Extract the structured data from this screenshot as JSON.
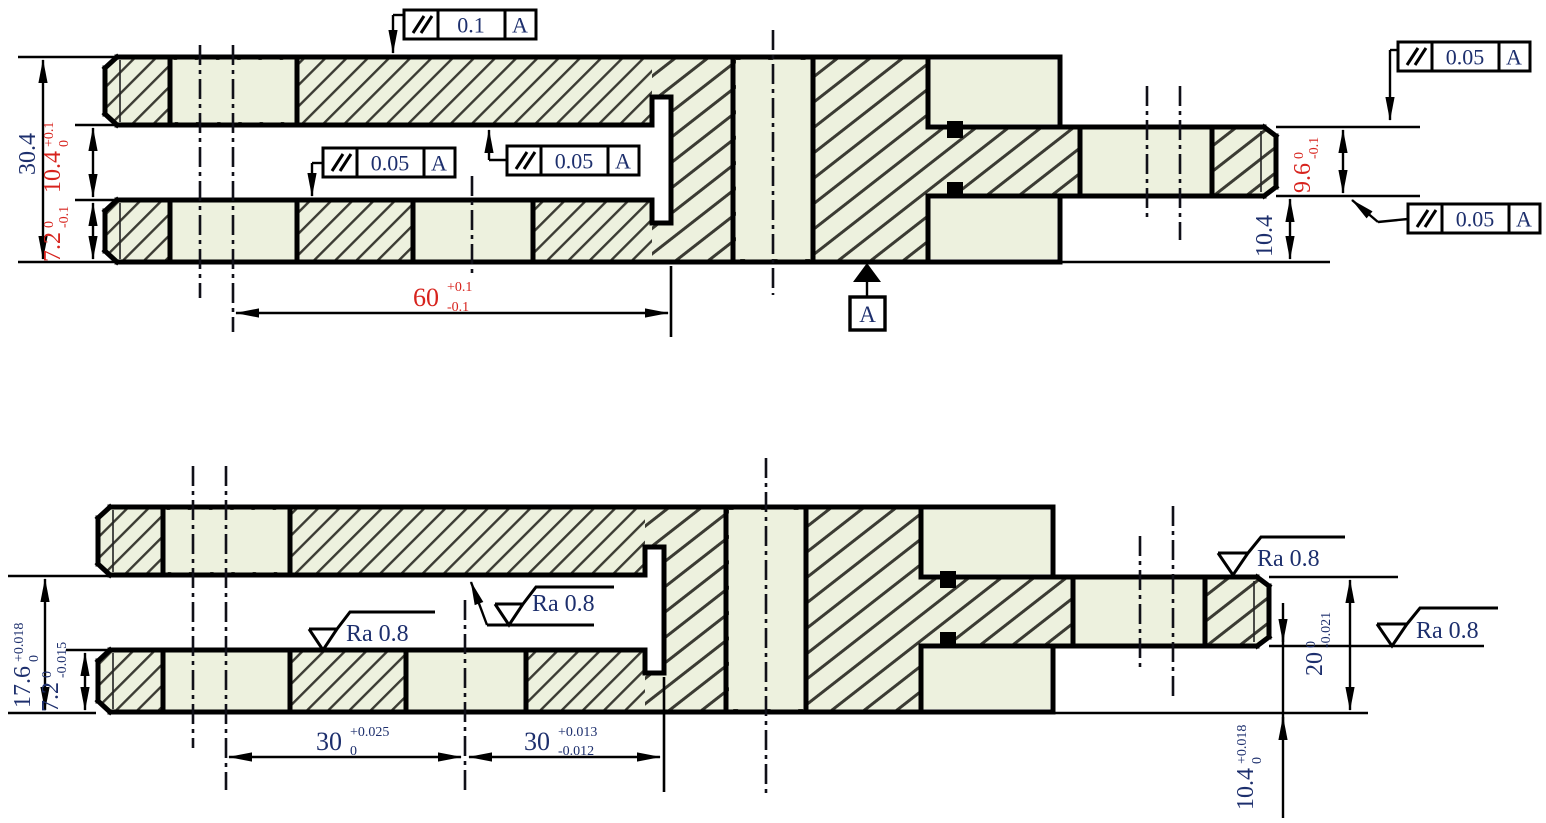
{
  "drawing": {
    "type": "mechanical-section-drawing",
    "views": [
      "top-section-view",
      "bottom-section-view"
    ]
  },
  "colors": {
    "red": "#d7231d",
    "ink": "#1d2f6d",
    "hatch_bg": "#edf1de",
    "hatch_line": "#3b3b33"
  },
  "top_view": {
    "fcf_top_surface": {
      "symbol": "parallelism",
      "tolerance": "0.1",
      "datum": "A"
    },
    "fcf_rail_top": {
      "symbol": "parallelism",
      "tolerance": "0.05",
      "datum": "A"
    },
    "fcf_slot_ceiling": {
      "symbol": "parallelism",
      "tolerance": "0.05",
      "datum": "A"
    },
    "fcf_arm_top": {
      "symbol": "parallelism",
      "tolerance": "0.05",
      "datum": "A"
    },
    "fcf_arm_bottom": {
      "symbol": "parallelism",
      "tolerance": "0.05",
      "datum": "A"
    },
    "datum_flag": {
      "label": "A"
    },
    "dim_overall_height": {
      "value": "30.4"
    },
    "dim_slot_height": {
      "value": "10.4",
      "upper": "+0.1",
      "lower": "0"
    },
    "dim_rail_height": {
      "value": "7.2",
      "upper": "0",
      "lower": "-0.1"
    },
    "dim_slot_length": {
      "value": "60",
      "upper": "+0.1",
      "lower": "-0.1"
    },
    "dim_arm_height": {
      "value": "9.6",
      "upper": "0",
      "lower": "-0.1"
    },
    "dim_base_height": {
      "value": "10.4"
    }
  },
  "bottom_view": {
    "dim_opening_height": {
      "value": "17.6",
      "upper": "+0.018",
      "lower": "0"
    },
    "dim_rail_height": {
      "value": "7.2",
      "upper": "0",
      "lower": "-0.015"
    },
    "dim_left_span": {
      "value": "30",
      "upper": "+0.025",
      "lower": "0"
    },
    "dim_right_span": {
      "value": "30",
      "upper": "+0.013",
      "lower": "-0.012"
    },
    "dim_step_height": {
      "value": "20",
      "upper": "0",
      "lower": "-0.021"
    },
    "dim_arm_offset": {
      "value": "10.4",
      "upper": "+0.018",
      "lower": "0"
    },
    "ra_rail_top": {
      "label": "Ra 0.8"
    },
    "ra_slot_ceiling": {
      "label": "Ra 0.8"
    },
    "ra_arm_top": {
      "label": "Ra 0.8"
    },
    "ra_arm_bottom": {
      "label": "Ra 0.8"
    }
  }
}
